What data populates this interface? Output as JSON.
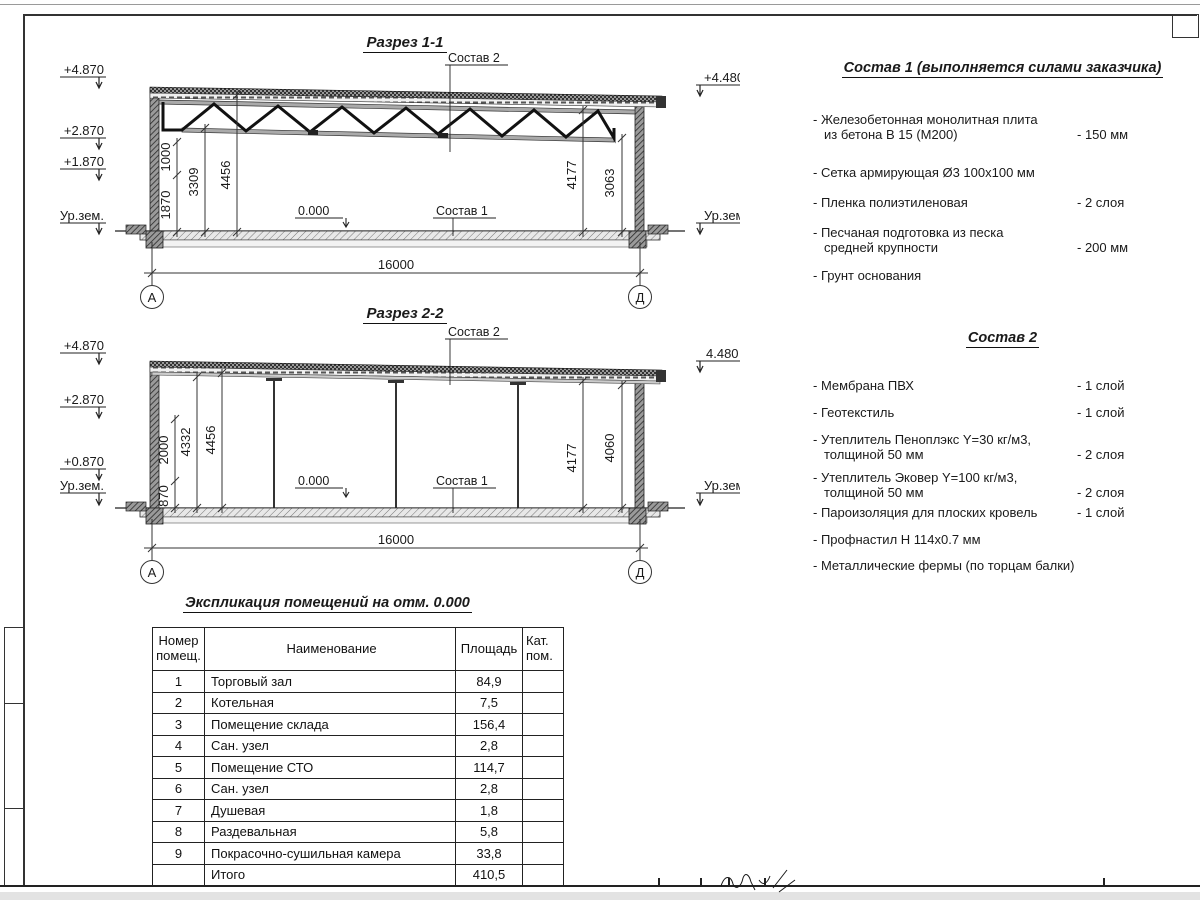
{
  "s1": {
    "title": "Разрез 1-1",
    "elev_left": [
      "+4.870",
      "+2.870",
      "+1.870",
      "Ур.зем."
    ],
    "elev_right": [
      "+4.480",
      "Ур.зем."
    ],
    "label_top": "Состав 2",
    "label_floor": "Состав 1",
    "label_zero": "0.000",
    "dim_v": [
      "1000",
      "1870",
      "3309",
      "4456",
      "4177",
      "3063"
    ],
    "dim_w": "16000",
    "axes": [
      "А",
      "Д"
    ]
  },
  "s2": {
    "title": "Разрез 2-2",
    "elev_left": [
      "+4.870",
      "+2.870",
      "+0.870",
      "Ур.зем."
    ],
    "elev_right": [
      "4.480",
      "Ур.зем."
    ],
    "label_top": "Состав 2",
    "label_floor": "Состав 1",
    "label_zero": "0.000",
    "dim_v": [
      "2000",
      "870",
      "4332",
      "4456",
      "4177",
      "4060"
    ],
    "dim_w": "16000",
    "axes": [
      "А",
      "Д"
    ]
  },
  "sostav1": {
    "title": "Состав 1 (выполняется силами заказчика)",
    "items": [
      {
        "l1": "- Железобетонная  монолитная плита",
        "l2": "из бетона В 15 (М200)",
        "v": "- 150 мм"
      },
      {
        "l1": "- Сетка армирующая Ø3 100х100 мм",
        "l2": "",
        "v": ""
      },
      {
        "l1": "- Пленка полиэтиленовая",
        "l2": "",
        "v": "-  2 слоя"
      },
      {
        "l1": "- Песчаная подготовка из песка",
        "l2": "средней крупности",
        "v": "- 200 мм"
      },
      {
        "l1": "- Грунт основания",
        "l2": "",
        "v": ""
      }
    ]
  },
  "sostav2": {
    "title": "Состав 2",
    "items": [
      {
        "l1": "- Мембрана ПВХ",
        "l2": "",
        "v": "- 1 слой"
      },
      {
        "l1": "- Геотекстиль",
        "l2": "",
        "v": "- 1 слой"
      },
      {
        "l1": "- Утеплитель Пеноплэкс Y=30 кг/м3,",
        "l2": "толщиной 50 мм",
        "v": "- 2 слоя"
      },
      {
        "l1": "- Утеплитель Эковер Y=100 кг/м3,",
        "l2": "толщиной 50 мм",
        "v": "- 2 слоя"
      },
      {
        "l1": "- Пароизоляция для плоских кровель",
        "l2": "",
        "v": "- 1 слой"
      },
      {
        "l1": "- Профнастил Н 114х0.7 мм",
        "l2": "",
        "v": ""
      },
      {
        "l1": "- Металлические фермы (по торцам балки)",
        "l2": "",
        "v": ""
      }
    ]
  },
  "table": {
    "title": "Экспликация помещений на отм. 0.000",
    "headers": [
      "Номер помещ.",
      "Наименование",
      "Площадь",
      "Кат. пом."
    ],
    "rows": [
      [
        "1",
        "Торговый зал",
        "84,9",
        ""
      ],
      [
        "2",
        "Котельная",
        "7,5",
        ""
      ],
      [
        "3",
        "Помещение склада",
        "156,4",
        ""
      ],
      [
        "4",
        "Сан. узел",
        "2,8",
        ""
      ],
      [
        "5",
        "Помещение СТО",
        "114,7",
        ""
      ],
      [
        "6",
        "Сан. узел",
        "2,8",
        ""
      ],
      [
        "7",
        "Душевая",
        "1,8",
        ""
      ],
      [
        "8",
        "Раздевальная",
        "5,8",
        ""
      ],
      [
        "9",
        "Покрасочно-сушильная камера",
        "33,8",
        ""
      ],
      [
        "",
        "Итого",
        "410,5",
        ""
      ]
    ]
  }
}
